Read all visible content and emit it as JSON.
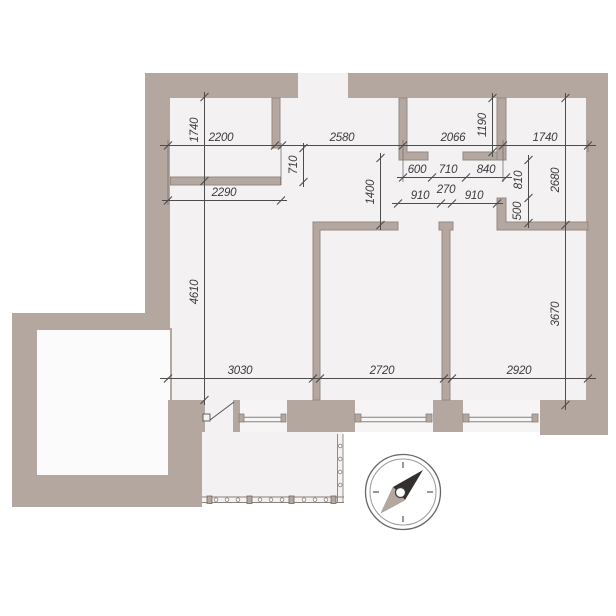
{
  "plan": {
    "type": "apartment-floor-plan",
    "colors": {
      "wall": "#b3a79f",
      "floor": "#f3f1f2",
      "adjacent_space": "#fcfbfb",
      "dimension_line": "#4c4c4c",
      "text": "#3b3b3b",
      "needle_dark": "#332f2c",
      "needle_light": "#b3a79f",
      "outside": "#ffffff"
    },
    "dims": {
      "left_room_depth": "1740",
      "left_room_width": "2200",
      "hall_top_width": "2580",
      "niche_width": "2066",
      "bedroom_top_width": "1740",
      "niche_depth": "1190",
      "left_door_width": "710",
      "closet_width": "2290",
      "seg_600": "600",
      "seg_710": "710",
      "seg_840": "840",
      "hall_depth": "1400",
      "bedroom_door": "810",
      "bedroom_depth": "2680",
      "door_room2": "910",
      "pier_width": "270",
      "door_room3": "910",
      "niche_return": "500",
      "living_depth": "4610",
      "room3_depth": "3670",
      "living_width": "3030",
      "room2_width": "2720",
      "room3_width": "2920"
    },
    "compass": {
      "kind": "compass-rose",
      "needle_direction": "north-east"
    }
  }
}
